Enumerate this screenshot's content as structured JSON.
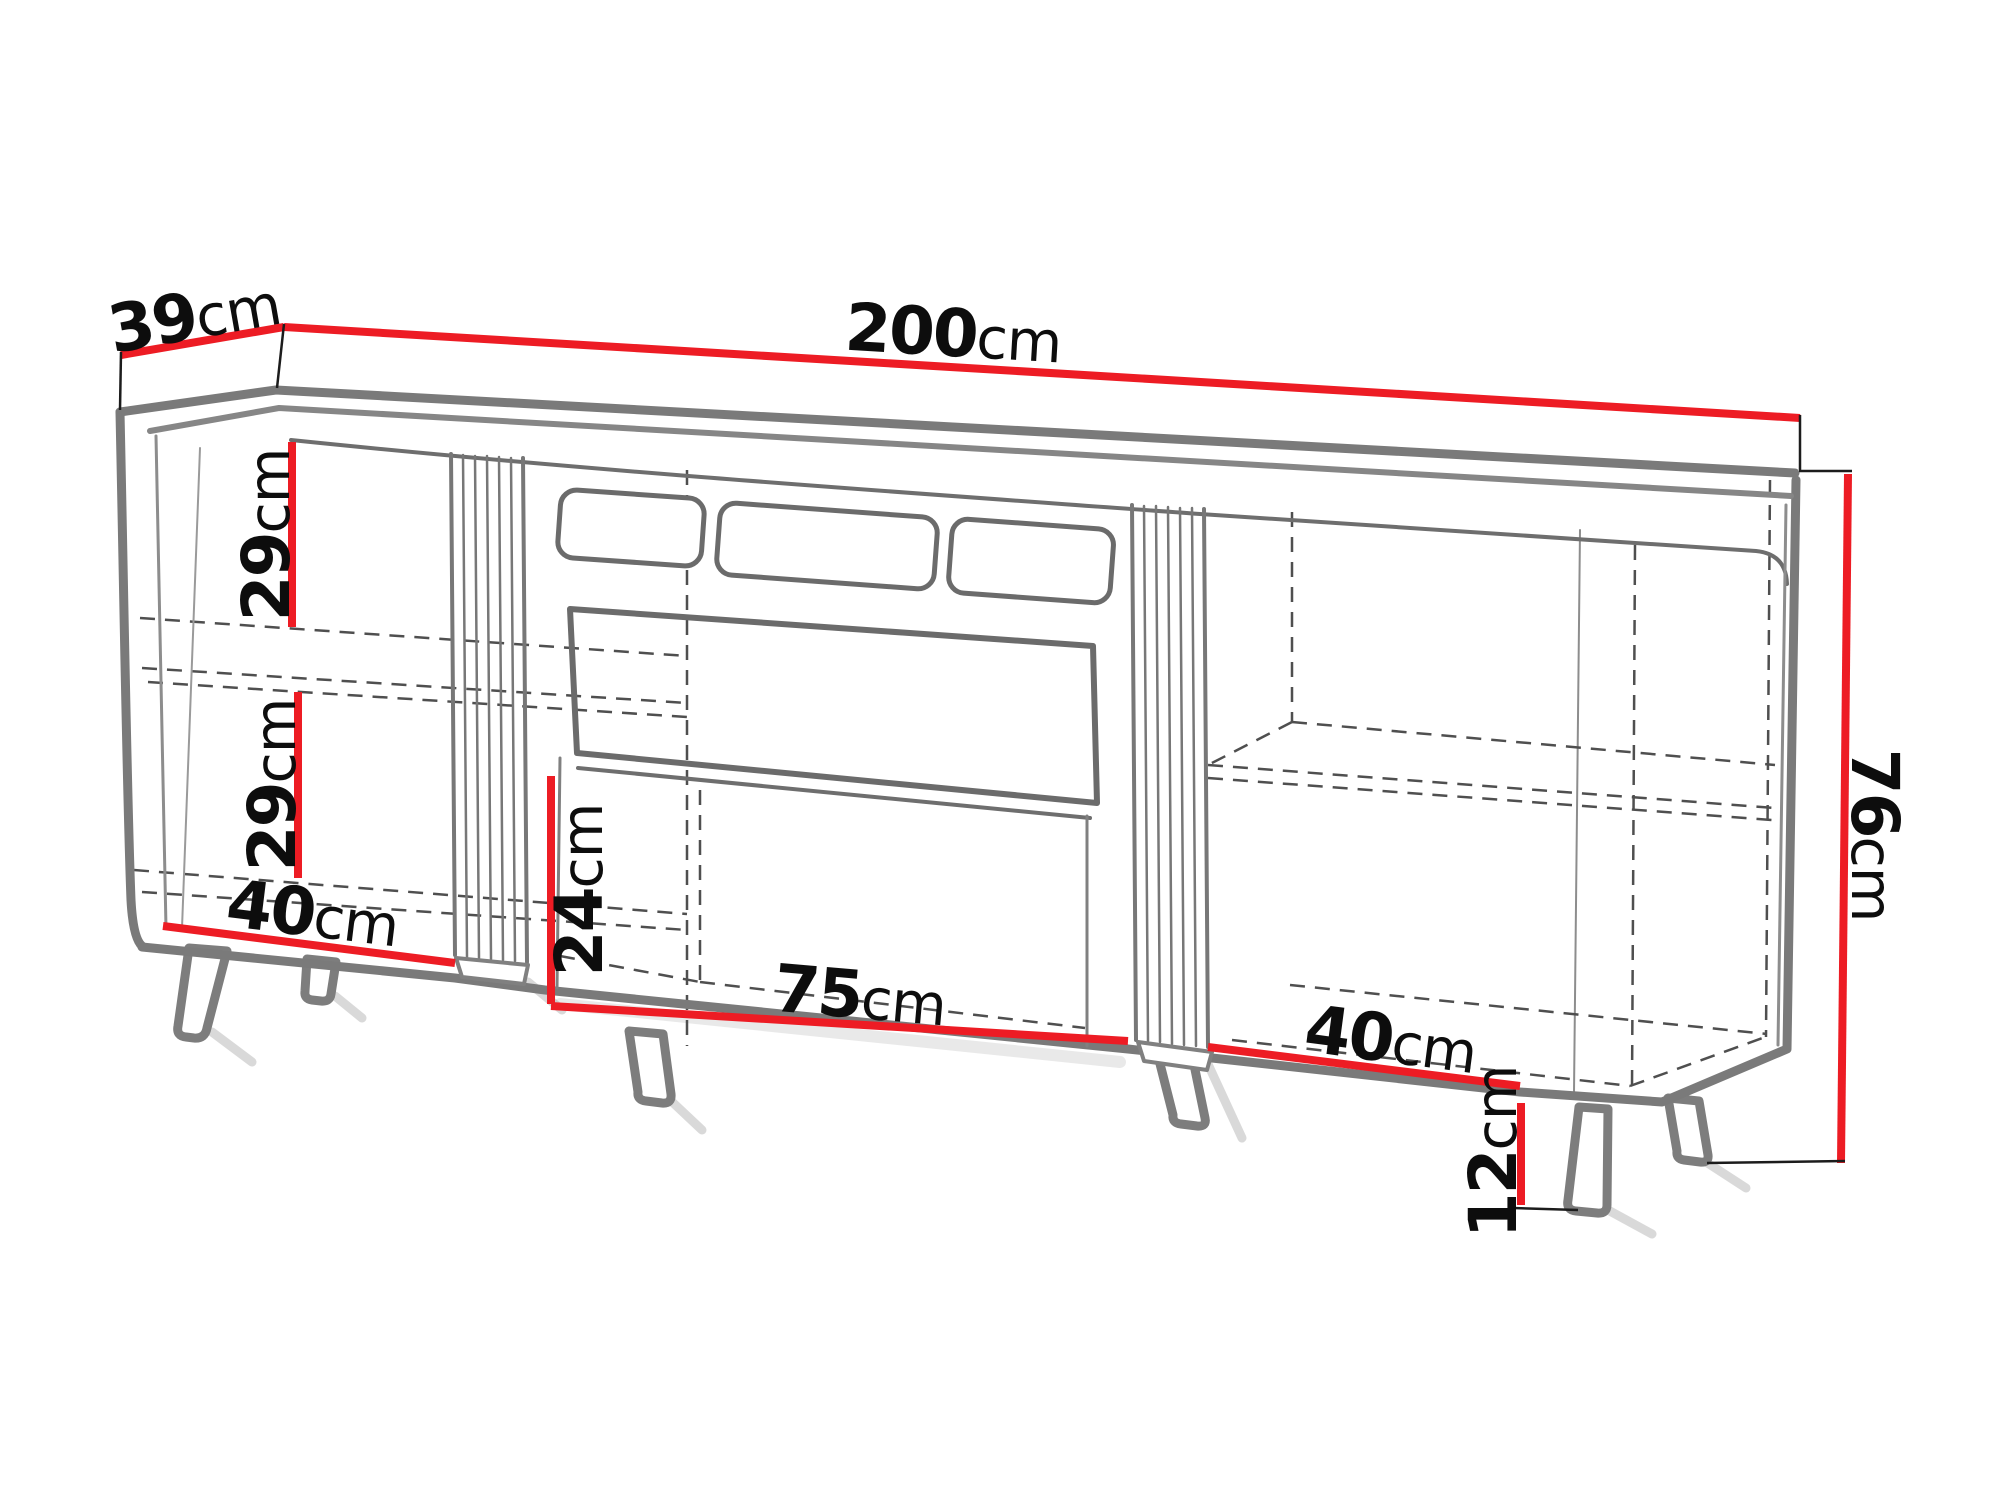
{
  "diagram": {
    "type": "furniture-dimension-drawing",
    "subject": "TV stand / sideboard perspective line drawing with slatted dividers, open middle niche and angled legs",
    "background_color": "#ffffff",
    "unit": "cm",
    "colors": {
      "dimension_line": "#ED1C24",
      "furniture_outline": "#7a7a7a",
      "hidden_edge": "#4f4f4f",
      "extension_line": "#1c1c1c",
      "label_text": "#0d0d0d"
    },
    "dimensions": [
      {
        "id": "depth",
        "value": "39",
        "unit": "cm",
        "measures": "cabinet depth (top left)"
      },
      {
        "id": "overall-width",
        "value": "200",
        "unit": "cm",
        "measures": "overall width (top)"
      },
      {
        "id": "upper-shelf-height",
        "value": "29",
        "unit": "cm",
        "measures": "left upper compartment height"
      },
      {
        "id": "lower-shelf-height",
        "value": "29",
        "unit": "cm",
        "measures": "left lower compartment height"
      },
      {
        "id": "left-section-width",
        "value": "40",
        "unit": "cm",
        "measures": "left compartment width"
      },
      {
        "id": "middle-height",
        "value": "24",
        "unit": "cm",
        "measures": "middle open compartment height"
      },
      {
        "id": "middle-width",
        "value": "75",
        "unit": "cm",
        "measures": "middle open compartment width"
      },
      {
        "id": "right-section-width",
        "value": "40",
        "unit": "cm",
        "measures": "right compartment width"
      },
      {
        "id": "overall-height",
        "value": "76",
        "unit": "cm",
        "measures": "overall height (right)"
      },
      {
        "id": "leg-height",
        "value": "12",
        "unit": "cm",
        "measures": "leg height"
      }
    ]
  }
}
